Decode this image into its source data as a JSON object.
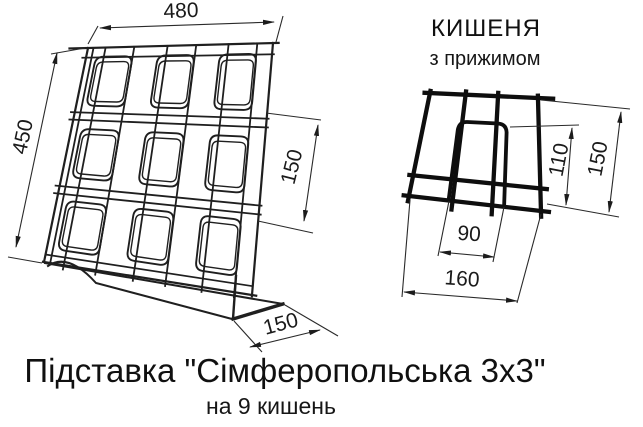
{
  "drawing": {
    "title": "Підставка \"Сімферопольська 3х3\"",
    "subtitle": "на 9 кишень",
    "ink_color": "#1c1c1c",
    "main_view": {
      "name": "stand-isometric-sketch",
      "pocket_rows": 3,
      "pocket_columns": 3,
      "dimensions": {
        "width": "480",
        "height": "450",
        "row_pitch": "150",
        "base_depth": "150"
      }
    },
    "detail_view": {
      "heading": "КИШЕНЯ",
      "subheading": "з прижимом",
      "dimensions": {
        "clamp_height": "110",
        "height": "150",
        "clamp_width": "90",
        "width": "160"
      }
    }
  }
}
